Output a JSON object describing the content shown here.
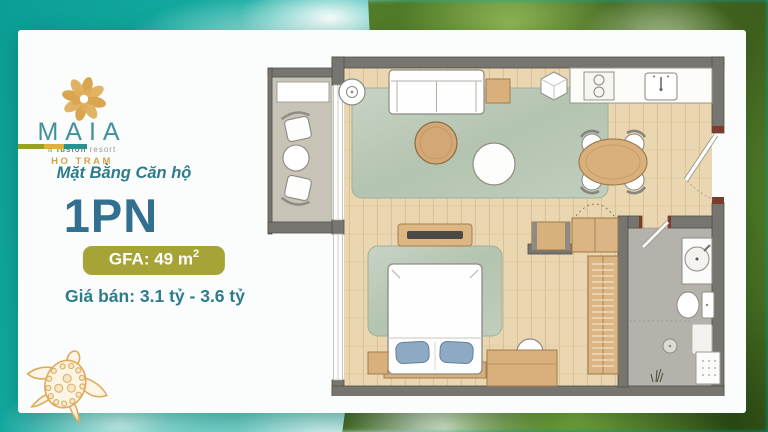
{
  "brand": {
    "name": "MAIA",
    "tagline_a": "a ",
    "tagline_b": "fusion",
    "tagline_c": " resort",
    "location": "HO TRAM"
  },
  "panel": {
    "subtitle": "Mặt Bằng Căn hộ",
    "unit_type": "1PN",
    "gfa_label": "GFA: 49 m",
    "gfa_superscript": "2",
    "price": "Giá bán: 3.1 tỷ - 3.6 tỷ"
  },
  "palette": {
    "brand_gold": "#D8A246",
    "brand_teal": "#41909B",
    "heading_teal": "#2E7B8B",
    "unit_teal": "#33708F",
    "badge_olive": "#A6A436",
    "divider_colors": [
      "#97A02C",
      "#DFAF3F",
      "#2F8E8E"
    ],
    "ocean_teal": "#11A89B",
    "foliage_green": "#3C5C1A"
  }
}
